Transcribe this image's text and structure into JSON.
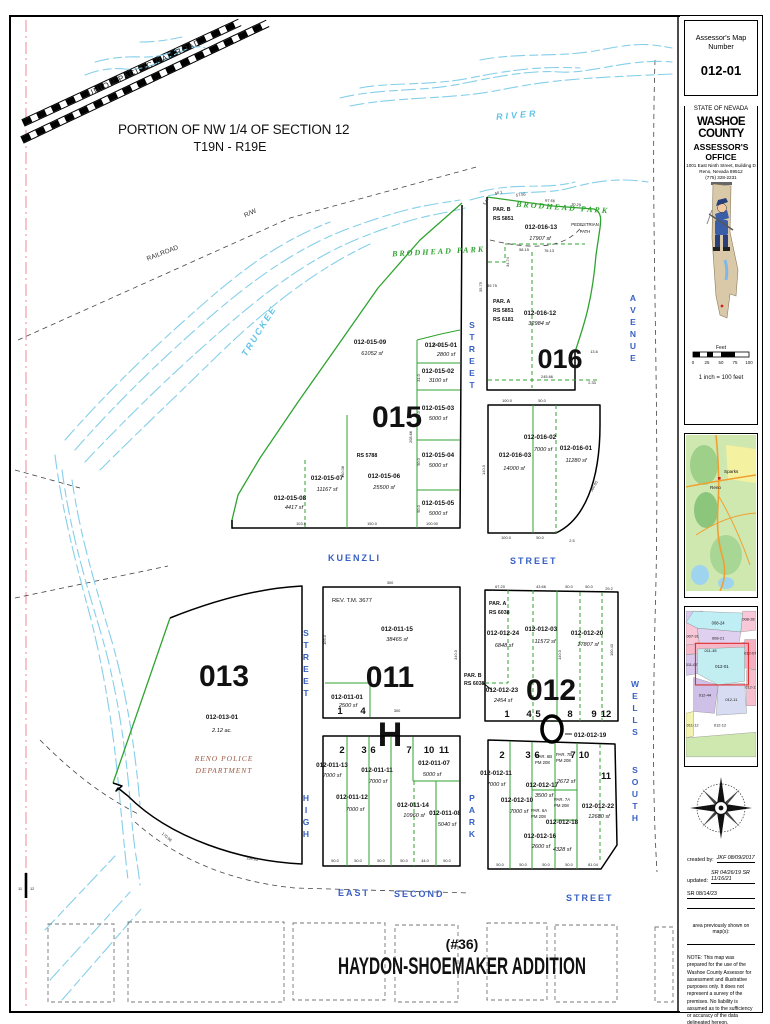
{
  "sidebar": {
    "map_number_label": "Assessor's Map Number",
    "map_number": "012-01",
    "state": "STATE OF NEVADA",
    "county": "WASHOE COUNTY",
    "office": "ASSESSOR'S OFFICE",
    "address1": "1001 East Ninth Street, Building D",
    "address2": "Reno, Nevada 89512",
    "address3": "(775) 328-2231",
    "scale_label": "Feet",
    "scale_ticks": [
      "0",
      "25",
      "50",
      "75",
      "100"
    ],
    "scale_caption": "1 inch = 100 feet",
    "county_map": {
      "city1": "Sparks",
      "city2": "Reno"
    },
    "index_map": {
      "n1": "008-24",
      "n2": "008-28",
      "n3": "007-31",
      "n4": "008-21",
      "n5": "011-45",
      "n6": "012-01",
      "n7": "012-07",
      "n8": "011-07",
      "n9": "012-44",
      "n10": "012-11",
      "n11": "012-13",
      "n12": "011-12",
      "n13": "012-12"
    },
    "created_label": "created by:",
    "created_value": "JKF 08/09/2017",
    "updated_label": "updated:",
    "updated_value": "SR 04/26/19   SR 11/16/21",
    "updated_value2": "SR 08/14/23",
    "prev_label": "area previously shown on map(s):",
    "note": "NOTE:  This map was prepared for the use of the Washoe County Assessor for assessment and illustrative purposes only.  It does not represent a survey of the premises.  No liability is assumed as to the sufficiency or accuracy of the data delineated hereon."
  },
  "map": {
    "title_line1": "PORTION OF NW 1/4 OF SECTION 12",
    "title_line2": "T19N - R19E",
    "railroad_label": "UNION PACIFIC RAILROAD",
    "railroad2_label": "RAILROAD",
    "rw_label": "R/W",
    "river_label": "RIVER",
    "truckee_label": "TRUCKEE",
    "park_label1": "BRODHEAD  PARK",
    "park_label2": "BRODHEAD  PARK",
    "pedestrian1": "PEDESTRIAN",
    "pedestrian2": "PATH",
    "section_left": "11",
    "section_right": "12",
    "letter_h": "H",
    "bottom_no": "(#36)",
    "bottom_title": "HAYDON-SHOEMAKER ADDITION",
    "streets": {
      "kuenzli": "KUENZLI",
      "kuenzli2": "STREET",
      "park_n": "STREET",
      "high_n": "STREET",
      "high": "HIGH",
      "park": "PARK",
      "wells": "WELLS",
      "south": "SOUTH",
      "avenue": "AVENUE",
      "east": "EAST",
      "second": "SECOND",
      "street": "STREET"
    },
    "b013": {
      "num": "013",
      "apn": "012-013-01",
      "area": "2.12 ac.",
      "owner1": "RENO  POLICE",
      "owner2": "DEPARTMENT"
    },
    "b015": {
      "num": "015",
      "rs": "RS 5788",
      "p09apn": "012-015-09",
      "p09sf": "61052 sf",
      "p01apn": "012-015-01",
      "p01sf": "2800 sf",
      "p02apn": "012-015-02",
      "p02sf": "3100 sf",
      "p03apn": "012-015-03",
      "p03sf": "5000 sf",
      "p04apn": "012-015-04",
      "p04sf": "5000 sf",
      "p05apn": "012-015-05",
      "p05sf": "5000 sf",
      "p06apn": "012-015-06",
      "p06sf": "25500 sf",
      "p07apn": "012-015-07",
      "p07sf": "11167 sf",
      "p08apn": "012-015-08",
      "p08sf": "4417 sf"
    },
    "b016": {
      "num": "016",
      "parb1": "PAR. B",
      "parb2": "RS 5851",
      "para1": "PAR. A",
      "para2": "RS 5851",
      "para3": "RS 6181",
      "p13apn": "012-016-13",
      "p13sf": "17907 sf",
      "p12apn": "012-016-12",
      "p12sf": "32984 sf",
      "p03apn": "012-016-03",
      "p03sf": "14000 sf",
      "p02apn": "012-016-02",
      "p02sf": "7000 sf",
      "p01apn": "012-016-01",
      "p01sf": "11280 sf"
    },
    "b011": {
      "num": "011",
      "rev": "REV. T.M. 3677",
      "p15apn": "012-011-15",
      "p15sf": "38465 sf",
      "p01apn": "012-011-01",
      "p01sf": "2500 sf",
      "p13apn": "012-011-13",
      "p13sf": "7000 sf",
      "p11apn": "012-011-11",
      "p11sf": "7000 sf",
      "p12apn": "012-011-12",
      "p12sf": "7000 sf",
      "p07apn": "012-011-07",
      "p07sf": "5000 sf",
      "p14apn": "012-011-14",
      "p14sf": "10960 sf",
      "p08apn": "012-011-08",
      "p08sf": "5040 sf",
      "l1": "1",
      "l4": "4",
      "l2": "2",
      "l3": "3",
      "l6": "6",
      "l7": "7",
      "l10": "10",
      "l11": "11"
    },
    "b012": {
      "num": "012",
      "para1": "PAR. A",
      "para2": "RS 6038",
      "parb1": "PAR. B",
      "parb2": "RS 6038",
      "p24apn": "012-012-24",
      "p24sf": "6848 sf",
      "p03apn": "012-012-03",
      "p03sf": "11572 sf",
      "p20apn": "012-012-20",
      "p20sf": "17807 sf",
      "p23apn": "012-012-23",
      "p23sf": "2454 sf",
      "p19apn": "012-012-19",
      "p11apn": "012-012-11",
      "p11sf": "7000 sf",
      "p17apn": "012-012-17",
      "p17sf": "3500 sf",
      "p10apn": "012-012-10",
      "p10sf": "7000 sf",
      "p16apn": "012-012-16",
      "p16sf": "2600 sf",
      "p18apn": "012-012-18",
      "p18sf": "4328 sf",
      "p22apn": "012-012-22",
      "p22sf": "12680 sf",
      "par6b1": "PAR. 6B",
      "par6b2": "PM 208",
      "par7b1": "PAR. 7B",
      "par7b2": "PM 208",
      "par7bsf": "2672 sf",
      "par6a1": "PAR. 6A",
      "par6a2": "PM 208",
      "par7a1": "PAR. 7A",
      "par7a2": "PM 208",
      "l1": "1",
      "l4": "4",
      "l5": "5",
      "l8": "8",
      "l9": "9",
      "l12": "12",
      "l2": "2",
      "l3": "3",
      "l6": "6",
      "l7": "7",
      "l10": "10",
      "l11": "11"
    },
    "dims": [
      "300",
      "300",
      "100.0",
      "31.0",
      "50.0",
      "50.0",
      "50.0",
      "208.66",
      "140.08",
      "103.5",
      "150.0",
      "100.00",
      "245.66",
      "100.0",
      "50.0",
      "140.0",
      "100.0",
      "50.0",
      "2.5",
      "160.05",
      "67.20",
      "43.66",
      "50.0",
      "50.0",
      "29.2",
      "140.0",
      "100.43",
      "50.0",
      "50.0",
      "50.0",
      "50.0",
      "44.0",
      "50.0",
      "50.0",
      "50.0",
      "50.0",
      "50.0",
      "81.04",
      "170.98",
      "199.65",
      "39.75",
      "34.74",
      "58.15",
      "76.13",
      "50.1",
      "57.55",
      "67.66",
      "70.29",
      "13.6",
      "35.75",
      "105.0",
      "340.0",
      "5.44",
      "2.33"
    ]
  }
}
